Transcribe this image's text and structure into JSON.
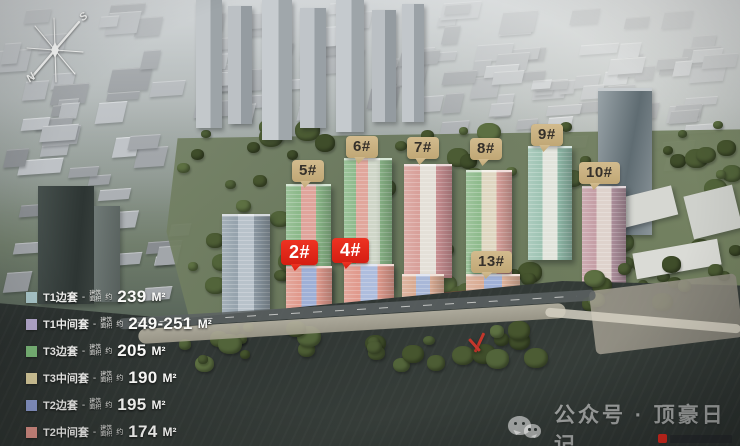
{
  "compass": {
    "south": "S",
    "north": "N"
  },
  "markers": [
    {
      "id": "2",
      "label": "2#",
      "style": "red",
      "x": 281,
      "y": 240
    },
    {
      "id": "4",
      "label": "4#",
      "style": "red",
      "x": 332,
      "y": 238
    },
    {
      "id": "5",
      "label": "5#",
      "style": "tan",
      "x": 292,
      "y": 160
    },
    {
      "id": "6",
      "label": "6#",
      "style": "tan",
      "x": 346,
      "y": 136
    },
    {
      "id": "7",
      "label": "7#",
      "style": "tan",
      "x": 407,
      "y": 137
    },
    {
      "id": "8",
      "label": "8#",
      "style": "tan",
      "x": 470,
      "y": 138
    },
    {
      "id": "9",
      "label": "9#",
      "style": "tan",
      "x": 531,
      "y": 124
    },
    {
      "id": "10",
      "label": "10#",
      "style": "tan",
      "x": 579,
      "y": 162
    },
    {
      "id": "13",
      "label": "13#",
      "style": "tan",
      "x": 471,
      "y": 251
    }
  ],
  "legend": {
    "separator": "-",
    "note_line1": "建筑",
    "note_line2": "面积",
    "approx": "约",
    "items": [
      {
        "color": "#a9c6c9",
        "name": "T1边套",
        "value": "239",
        "unit": "M²"
      },
      {
        "color": "#b5a9cd",
        "name": "T1中间套",
        "value": "249-251",
        "unit": "M²"
      },
      {
        "color": "#7cb97a",
        "name": "T3边套",
        "value": "205",
        "unit": "M²"
      },
      {
        "color": "#ddd0a0",
        "name": "T3中间套",
        "value": "190",
        "unit": "M²"
      },
      {
        "color": "#8e9dd1",
        "name": "T2边套",
        "value": "195",
        "unit": "M²"
      },
      {
        "color": "#e1958b",
        "name": "T2中间套",
        "value": "174",
        "unit": "M²"
      }
    ]
  },
  "watermark": {
    "text": "公众号 · 顶豪日记",
    "icon": "wechat-icon"
  },
  "site_buildings": [
    {
      "id": "tower-5",
      "x": 286,
      "y": 184,
      "w": 45,
      "h": 116,
      "stripes": [
        "#8cb98a",
        "#dfa49b",
        "#8cb98a"
      ]
    },
    {
      "id": "tower-6",
      "x": 344,
      "y": 158,
      "w": 48,
      "h": 126,
      "stripes": [
        "#8cb98a",
        "#e0a79c",
        "#cfd6c8",
        "#8cb98a"
      ]
    },
    {
      "id": "tower-7",
      "x": 404,
      "y": 164,
      "w": 48,
      "h": 112,
      "stripes": [
        "#d8a09a",
        "#e4e0d8",
        "#c98f92"
      ]
    },
    {
      "id": "tower-8",
      "x": 466,
      "y": 170,
      "w": 46,
      "h": 102,
      "stripes": [
        "#8fbb8d",
        "#dfd7c2",
        "#d8a09a"
      ]
    },
    {
      "id": "tower-9",
      "x": 528,
      "y": 146,
      "w": 44,
      "h": 112,
      "stripes": [
        "#9fc4b4",
        "#e2e4dc",
        "#8fb9a8"
      ]
    },
    {
      "id": "tower-10",
      "x": 582,
      "y": 186,
      "w": 44,
      "h": 102,
      "stripes": [
        "#c59fa6",
        "#ded2cc",
        "#ad8f9c"
      ]
    },
    {
      "id": "lowrise-2",
      "x": 286,
      "y": 266,
      "w": 46,
      "h": 60,
      "stripes": [
        "#e09a8d",
        "#9fb0d6",
        "#e09a8d"
      ]
    },
    {
      "id": "lowrise-4",
      "x": 344,
      "y": 264,
      "w": 50,
      "h": 62,
      "stripes": [
        "#e09a8d",
        "#aebddd",
        "#e09a8d"
      ]
    },
    {
      "id": "lowrise-mid",
      "x": 402,
      "y": 274,
      "w": 42,
      "h": 48,
      "stripes": [
        "#d9ab93",
        "#a9b8d8",
        "#d9ab93"
      ]
    },
    {
      "id": "lowrise-13",
      "x": 466,
      "y": 274,
      "w": 54,
      "h": 52,
      "stripes": [
        "#d9ab93",
        "#9fb0d6",
        "#e0b49c"
      ]
    },
    {
      "id": "slab-west",
      "x": 222,
      "y": 214,
      "w": 48,
      "h": 112,
      "stripes": [
        "#96a3ad",
        "#b8c2ca",
        "#8b98a2"
      ]
    }
  ],
  "colors": {
    "marker_tan": "#c8af7e",
    "marker_red": "#e02619",
    "water": "#2e3432",
    "legend_text": "#f3f3f1"
  }
}
